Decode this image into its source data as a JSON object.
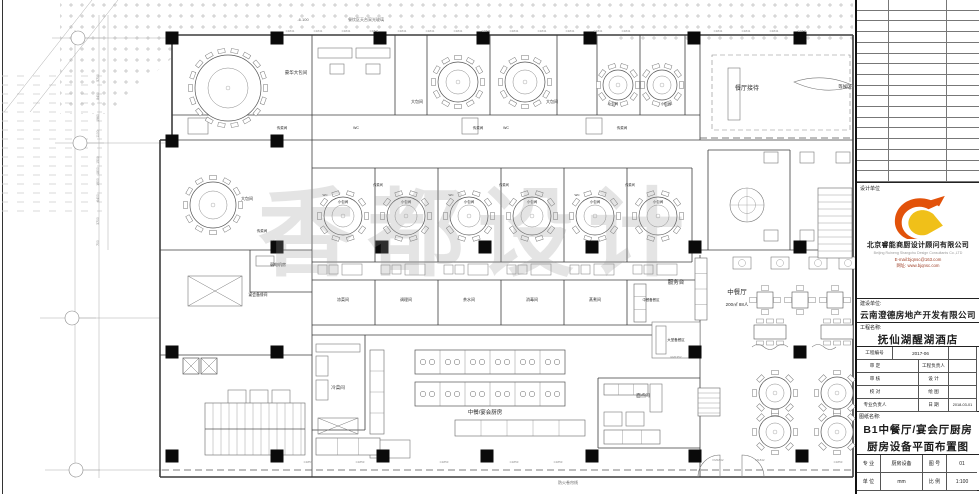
{
  "colors": {
    "line": "#3c3c3c",
    "furniture": "#787878",
    "hatch": "#bdbdbd",
    "column": "#0a0a0a",
    "accent_red": "#a04028",
    "logo_orange": "#e2520a",
    "logo_yellow": "#f0c019",
    "watermark_gray": "#969696"
  },
  "titleblock": {
    "revision_rows": 17,
    "design_unit_label": "设计单位",
    "company_cn": "北京睿能商厨设计顾问有限公司",
    "company_en": "Beijing Ruineng Shangchu Design Consultants Co.,LTD",
    "email": "E-mail:bjqnsc@163.com",
    "website": "网址: www.bjqnsc.com",
    "client_label": "建设单位:",
    "client": "云南澄德房地产开发有限公司",
    "project_label": "工程名称:",
    "project": "抚仙湖醒湖酒店",
    "fields": {
      "project_no_label": "工程编号",
      "project_no": "2017-06",
      "approve_label": "审 定",
      "chief_label": "工程负责人",
      "review_label": "审 核",
      "design_label": "设 计",
      "proof_label": "校 对",
      "draw_label": "绘 图",
      "lead_label": "专业负责人",
      "date_label": "日 期",
      "date": "2018-03-01"
    },
    "drawing_name_label": "图纸名称:",
    "drawing_name_line1": "B1中餐厅/宴会厅厨房",
    "drawing_name_line2": "厨房设备平面布置图",
    "bottom": {
      "major_label": "专 业",
      "major": "厨房设备",
      "no_label": "图 号",
      "no": "01",
      "unit_label": "单 位",
      "unit": "mm",
      "scale_label": "比 例",
      "scale": "1:100"
    }
  },
  "plan": {
    "watermark": "香都设计",
    "hatch_polys": [
      "60,0 618,0 618,34 172,34 172,58 108,114 60,114"
    ],
    "hatch_rects": [
      [
        615,
        0,
        238,
        46
      ]
    ],
    "dashhatch_rects": [
      [
        2,
        70,
        100,
        145
      ]
    ],
    "columns": {
      "size": 13,
      "pts": [
        [
          172,
          38
        ],
        [
          277,
          38
        ],
        [
          380,
          38
        ],
        [
          483,
          38
        ],
        [
          590,
          38
        ],
        [
          694,
          38
        ],
        [
          800,
          38
        ],
        [
          172,
          141
        ],
        [
          277,
          141
        ],
        [
          277,
          247
        ],
        [
          382,
          247
        ],
        [
          485,
          247
        ],
        [
          592,
          247
        ],
        [
          695,
          247
        ],
        [
          800,
          247
        ],
        [
          172,
          352
        ],
        [
          277,
          352
        ],
        [
          695,
          352
        ],
        [
          800,
          352
        ],
        [
          172,
          456
        ],
        [
          277,
          456
        ],
        [
          383,
          456
        ],
        [
          487,
          456
        ],
        [
          592,
          456
        ],
        [
          695,
          456
        ],
        [
          802,
          456
        ]
      ]
    },
    "walls": [
      [
        172,
        35,
        853,
        35,
        1.6
      ],
      [
        853,
        35,
        853,
        477,
        1.6
      ],
      [
        160,
        477,
        853,
        477,
        1.6
      ],
      [
        172,
        35,
        172,
        140,
        1.6
      ],
      [
        160,
        140,
        172,
        140,
        1.6
      ],
      [
        160,
        140,
        160,
        477,
        1.6
      ],
      [
        172,
        115,
        700,
        115
      ],
      [
        172,
        140,
        853,
        140
      ],
      [
        312,
        35,
        312,
        477
      ],
      [
        395,
        35,
        395,
        115
      ],
      [
        427,
        35,
        427,
        115
      ],
      [
        490,
        35,
        490,
        115
      ],
      [
        557,
        35,
        557,
        115
      ],
      [
        597,
        35,
        597,
        115
      ],
      [
        640,
        35,
        640,
        115
      ],
      [
        685,
        35,
        685,
        115
      ],
      [
        700,
        35,
        700,
        140
      ],
      [
        312,
        168,
        692,
        168
      ],
      [
        312,
        262,
        692,
        262
      ],
      [
        375,
        168,
        375,
        262
      ],
      [
        438,
        168,
        438,
        262
      ],
      [
        501,
        168,
        501,
        262
      ],
      [
        564,
        168,
        564,
        262
      ],
      [
        627,
        168,
        627,
        262
      ],
      [
        692,
        168,
        692,
        262
      ],
      [
        312,
        280,
        700,
        280
      ],
      [
        312,
        325,
        700,
        325
      ],
      [
        375,
        280,
        375,
        325
      ],
      [
        438,
        280,
        438,
        325
      ],
      [
        501,
        280,
        501,
        325
      ],
      [
        564,
        280,
        564,
        325
      ],
      [
        627,
        280,
        627,
        325
      ],
      [
        160,
        250,
        312,
        250
      ],
      [
        250,
        250,
        250,
        292
      ],
      [
        250,
        292,
        312,
        292
      ],
      [
        160,
        355,
        312,
        355
      ],
      [
        312,
        335,
        700,
        335
      ],
      [
        365,
        335,
        365,
        430
      ],
      [
        312,
        430,
        365,
        430
      ],
      [
        598,
        378,
        700,
        378
      ],
      [
        598,
        378,
        598,
        448
      ],
      [
        598,
        448,
        700,
        448
      ],
      [
        700,
        255,
        700,
        477
      ],
      [
        700,
        250,
        853,
        250
      ],
      [
        708,
        150,
        708,
        250
      ],
      [
        790,
        150,
        790,
        250
      ],
      [
        708,
        150,
        790,
        150
      ]
    ],
    "thin": [
      [
        99,
        15,
        99,
        478
      ],
      [
        75,
        30,
        75,
        478
      ],
      [
        108,
        15,
        108,
        250
      ],
      [
        52,
        38,
        170,
        38
      ],
      [
        55,
        143,
        170,
        143
      ],
      [
        40,
        318,
        160,
        318
      ],
      [
        45,
        470,
        162,
        470
      ],
      [
        118,
        0,
        30,
        112
      ],
      [
        92,
        0,
        4,
        112
      ]
    ],
    "dash_lines": [
      [
        162,
        470,
        852,
        470
      ],
      [
        700,
        138,
        852,
        138
      ]
    ],
    "dash_rects": [
      [
        712,
        55,
        138,
        75
      ]
    ],
    "diag_rects": [
      [
        188,
        276,
        54,
        30
      ],
      [
        318,
        418,
        40,
        16
      ]
    ],
    "rects": [
      [
        318,
        48,
        34,
        10
      ],
      [
        356,
        48,
        34,
        10
      ],
      [
        330,
        64,
        14,
        10
      ],
      [
        366,
        64,
        14,
        10
      ],
      [
        188,
        118,
        20,
        16
      ],
      [
        462,
        118,
        16,
        16
      ],
      [
        586,
        118,
        16,
        16
      ],
      [
        256,
        256,
        18,
        10
      ],
      [
        652,
        322,
        48,
        36
      ],
      [
        656,
        326,
        10,
        28
      ],
      [
        316,
        344,
        44,
        8
      ],
      [
        316,
        356,
        12,
        20
      ],
      [
        316,
        380,
        12,
        20
      ],
      [
        604,
        412,
        18,
        14
      ],
      [
        626,
        412,
        18,
        14
      ],
      [
        650,
        384,
        12,
        28
      ],
      [
        370,
        440,
        40,
        18
      ],
      [
        728,
        68,
        12,
        52
      ],
      [
        764,
        152,
        14,
        11
      ],
      [
        800,
        152,
        14,
        11
      ],
      [
        836,
        152,
        14,
        11
      ],
      [
        764,
        230,
        14,
        11
      ],
      [
        800,
        230,
        14,
        11
      ],
      [
        836,
        230,
        14,
        11
      ],
      [
        228,
        390,
        18,
        14
      ],
      [
        250,
        390,
        18,
        14
      ],
      [
        272,
        390,
        18,
        14
      ]
    ],
    "counters": [
      [
        695,
        258,
        12,
        62,
        4
      ],
      [
        455,
        420,
        130,
        16,
        5
      ],
      [
        316,
        438,
        64,
        17,
        3
      ],
      [
        604,
        430,
        56,
        14,
        3
      ],
      [
        370,
        350,
        14,
        84,
        4
      ],
      [
        604,
        384,
        44,
        11,
        3
      ],
      [
        634,
        284,
        12,
        38,
        3
      ]
    ],
    "cooklines": [
      [
        415,
        350,
        150,
        24,
        6
      ],
      [
        415,
        382,
        150,
        24,
        6
      ]
    ],
    "sink_rows": [
      {
        "x": 318,
        "y": 265,
        "n": 6,
        "pitch": 63
      }
    ],
    "round_tables": [
      {
        "x": 228,
        "y": 88,
        "r": 33,
        "ir": 20,
        "n": 18
      },
      {
        "x": 458,
        "y": 82,
        "r": 20,
        "ir": 12,
        "n": 12
      },
      {
        "x": 525,
        "y": 82,
        "r": 20,
        "ir": 12,
        "n": 12
      },
      {
        "x": 618,
        "y": 85,
        "r": 15,
        "ir": 9,
        "n": 10
      },
      {
        "x": 662,
        "y": 85,
        "r": 15,
        "ir": 9,
        "n": 10
      },
      {
        "x": 213,
        "y": 205,
        "r": 23,
        "ir": 14,
        "n": 12
      },
      {
        "x": 343,
        "y": 216,
        "r": 19,
        "ir": 11,
        "n": 10
      },
      {
        "x": 406,
        "y": 216,
        "r": 19,
        "ir": 11,
        "n": 10
      },
      {
        "x": 469,
        "y": 216,
        "r": 19,
        "ir": 11,
        "n": 10
      },
      {
        "x": 532,
        "y": 216,
        "r": 19,
        "ir": 11,
        "n": 10
      },
      {
        "x": 595,
        "y": 216,
        "r": 19,
        "ir": 11,
        "n": 10
      },
      {
        "x": 658,
        "y": 216,
        "r": 19,
        "ir": 11,
        "n": 10
      },
      {
        "x": 775,
        "y": 393,
        "r": 16,
        "ir": 9,
        "n": 8
      },
      {
        "x": 837,
        "y": 393,
        "r": 16,
        "ir": 9,
        "n": 8
      },
      {
        "x": 775,
        "y": 432,
        "r": 16,
        "ir": 9,
        "n": 8
      },
      {
        "x": 837,
        "y": 432,
        "r": 16,
        "ir": 9,
        "n": 8
      }
    ],
    "sq_tables": [
      {
        "x": 765,
        "y": 300
      },
      {
        "x": 800,
        "y": 300
      },
      {
        "x": 835,
        "y": 300
      }
    ],
    "rect6_tables": [
      {
        "x": 770,
        "y": 332
      },
      {
        "x": 837,
        "y": 332
      }
    ],
    "wall_tables": [
      {
        "x": 742,
        "y": 263
      },
      {
        "x": 780,
        "y": 263
      },
      {
        "x": 818,
        "y": 263
      },
      {
        "x": 848,
        "y": 263
      }
    ],
    "stairs": [
      {
        "x": 205,
        "y": 403,
        "w": 100,
        "h": 52,
        "step": 8,
        "dir": "v"
      },
      {
        "x": 698,
        "y": 388,
        "w": 22,
        "h": 28,
        "step": 5,
        "dir": "h"
      },
      {
        "x": 818,
        "y": 188,
        "w": 34,
        "h": 70,
        "step": 7,
        "dir": "h"
      }
    ],
    "xboxes": [
      [
        183,
        358,
        16,
        16
      ],
      [
        201,
        358,
        16,
        16
      ]
    ],
    "planters": [
      {
        "x": 747,
        "y": 205,
        "r": 17
      }
    ],
    "paths": [
      {
        "d": "M794 82 Q824 72 854 86 Q824 96 794 82 Z",
        "n": "feature-wall"
      },
      {
        "d": "M698 477 A22 22 0 0 1 720 455 L720 477",
        "n": "door-swing"
      },
      {
        "d": "M764 477 A22 22 0 0 0 742 455 L742 477",
        "n": "door-swing"
      },
      {
        "d": "M752 347 q6 -5 12 0 t12 0 t12 0",
        "n": "decor-wave"
      },
      {
        "d": "M812 347 q6 -5 12 0 t12 0",
        "n": "decor-wave"
      }
    ],
    "bubbles": [
      [
        78,
        38
      ],
      [
        80,
        143
      ],
      [
        72,
        318
      ],
      [
        76,
        470
      ]
    ],
    "dims": [
      [
        "5700",
        78
      ],
      [
        "8400",
        96
      ],
      [
        "1960",
        118
      ],
      [
        "1100",
        134
      ],
      [
        "1500",
        160
      ],
      [
        "1800",
        171
      ],
      [
        "1500",
        182
      ],
      [
        "6400",
        198
      ],
      [
        "3700",
        221
      ],
      [
        "700",
        243
      ]
    ],
    "win_top": {
      "t": "C1841",
      "y": 32,
      "xs": [
        290,
        318,
        346,
        374,
        402,
        430,
        458,
        486,
        514,
        542,
        570,
        598,
        626,
        718,
        746,
        774,
        802
      ]
    },
    "win_bottom": {
      "t": "C1853",
      "y": 463,
      "xs": [
        308,
        360,
        444,
        514,
        558,
        838
      ]
    },
    "door_tags": [
      {
        "t": "FM1842",
        "x": 718,
        "y": 461
      },
      {
        "t": "M1842",
        "x": 760,
        "y": 461
      },
      {
        "t": "FM1352",
        "x": 676,
        "y": 358
      }
    ],
    "labels": [
      {
        "t": "豪华大包间",
        "x": 296,
        "y": 74,
        "s": 4.5
      },
      {
        "t": "大包间",
        "x": 417,
        "y": 103,
        "s": 4
      },
      {
        "t": "大包间",
        "x": 552,
        "y": 103,
        "s": 4
      },
      {
        "t": "小包间",
        "x": 613,
        "y": 105,
        "s": 3.5
      },
      {
        "t": "小包间",
        "x": 666,
        "y": 105,
        "s": 3.5
      },
      {
        "t": "餐厅接待",
        "x": 747,
        "y": 90,
        "s": 6
      },
      {
        "t": "等候区",
        "x": 845,
        "y": 88,
        "s": 4.5
      },
      {
        "t": "-6.100",
        "x": 303,
        "y": 21,
        "s": 4,
        "c": "#666"
      },
      {
        "t": "餐饮区天台采光玻璃",
        "x": 366,
        "y": 21,
        "s": 4,
        "c": "#666"
      },
      {
        "t": "传菜间",
        "x": 282,
        "y": 129,
        "s": 3.5
      },
      {
        "t": "WC",
        "x": 356,
        "y": 129,
        "s": 3.5
      },
      {
        "t": "传菜间",
        "x": 478,
        "y": 129,
        "s": 3.5
      },
      {
        "t": "WC",
        "x": 506,
        "y": 129,
        "s": 3.5
      },
      {
        "t": "传菜间",
        "x": 622,
        "y": 129,
        "s": 3.5
      },
      {
        "t": "大包间",
        "x": 247,
        "y": 200,
        "s": 4
      },
      {
        "t": "传菜间",
        "x": 262,
        "y": 232,
        "s": 3.5
      },
      {
        "t": "弱电机房",
        "x": 278,
        "y": 266,
        "s": 4
      },
      {
        "t": "宴会备餐间",
        "x": 258,
        "y": 296,
        "s": 3.8
      },
      {
        "t": "传菜间",
        "x": 378,
        "y": 186,
        "s": 3.2
      },
      {
        "t": "传菜间",
        "x": 504,
        "y": 186,
        "s": 3.2
      },
      {
        "t": "传菜间",
        "x": 630,
        "y": 186,
        "s": 3.2
      },
      {
        "t": "WC",
        "x": 325,
        "y": 196,
        "s": 3
      },
      {
        "t": "WC",
        "x": 451,
        "y": 196,
        "s": 3
      },
      {
        "t": "WC",
        "x": 577,
        "y": 196,
        "s": 3
      },
      {
        "t": "小包间",
        "x": 343,
        "y": 203,
        "s": 3.5
      },
      {
        "t": "小包间",
        "x": 406,
        "y": 203,
        "s": 3.5
      },
      {
        "t": "小包间",
        "x": 469,
        "y": 203,
        "s": 3.5
      },
      {
        "t": "小包间",
        "x": 532,
        "y": 203,
        "s": 3.5
      },
      {
        "t": "小包间",
        "x": 595,
        "y": 203,
        "s": 3.5
      },
      {
        "t": "小包间",
        "x": 658,
        "y": 203,
        "s": 3.5
      },
      {
        "t": "凉菜间",
        "x": 343,
        "y": 301,
        "s": 4
      },
      {
        "t": "调理间",
        "x": 406,
        "y": 301,
        "s": 4
      },
      {
        "t": "茶水间",
        "x": 469,
        "y": 301,
        "s": 4
      },
      {
        "t": "消毒间",
        "x": 532,
        "y": 301,
        "s": 4
      },
      {
        "t": "蒸煮间",
        "x": 595,
        "y": 301,
        "s": 4
      },
      {
        "t": "中餐备餐区",
        "x": 651,
        "y": 301,
        "s": 3.4
      },
      {
        "t": "冷菜间",
        "x": 338,
        "y": 389,
        "s": 4.5
      },
      {
        "t": "中餐/宴会厨房",
        "x": 485,
        "y": 414,
        "s": 5.5
      },
      {
        "t": "面点间",
        "x": 643,
        "y": 397,
        "s": 4.5
      },
      {
        "t": "服务台",
        "x": 676,
        "y": 284,
        "s": 5.5
      },
      {
        "t": "中餐厅",
        "x": 737,
        "y": 294,
        "s": 6.5
      },
      {
        "t": "200㎡ 88人",
        "x": 737,
        "y": 306,
        "s": 4.5
      },
      {
        "t": "大堂备餐区",
        "x": 676,
        "y": 341,
        "s": 3.5
      },
      {
        "t": "防火卷帘线",
        "x": 568,
        "y": 484,
        "s": 4,
        "c": "#666"
      }
    ]
  }
}
